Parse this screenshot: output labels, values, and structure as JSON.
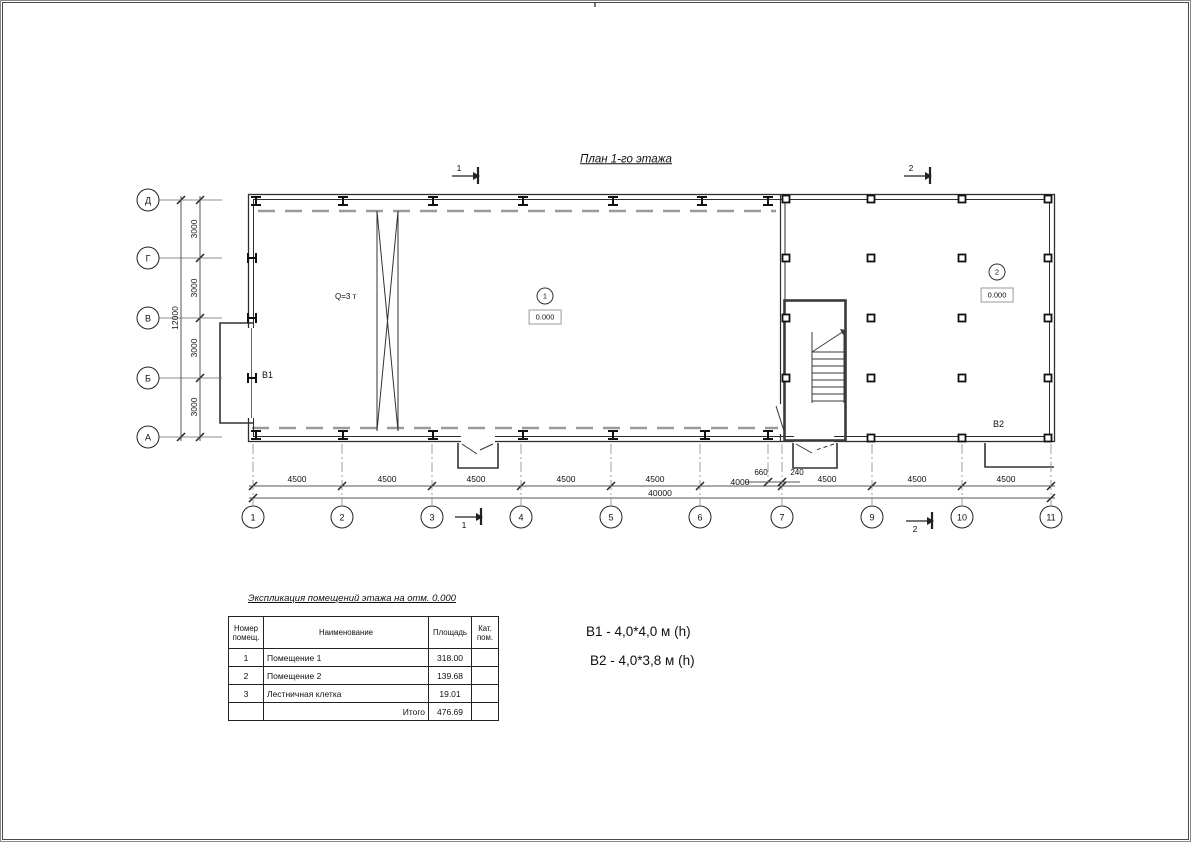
{
  "title": "План 1-го этажа",
  "plan": {
    "crane_label": "Q=3 т",
    "room_markers": {
      "r1": "1",
      "r2": "2"
    },
    "elevations": {
      "e1": "0.000",
      "e2": "0.000"
    },
    "b1": "В1",
    "b2": "В2"
  },
  "grid": {
    "row_labels": [
      "Д",
      "Г",
      "В",
      "Б",
      "А"
    ],
    "col_labels": [
      "1",
      "2",
      "3",
      "4",
      "5",
      "6",
      "7",
      "9",
      "10",
      "11"
    ]
  },
  "dims": {
    "left_segments": [
      "3000",
      "3000",
      "3000",
      "3000"
    ],
    "left_total": "12000",
    "bottom_segments": [
      "4500",
      "4500",
      "4500",
      "4500",
      "4500",
      "4000",
      "4500",
      "4500",
      "4500"
    ],
    "bottom_small": [
      "660",
      "240"
    ],
    "bottom_total": "40000"
  },
  "sections": {
    "top_1": "1",
    "top_2": "2",
    "bottom_1": "1",
    "bottom_2": "2"
  },
  "legend": {
    "line1": "В1  -  4,0*4,0 м (h)",
    "line2": "В2 - 4,0*3,8 м (h)"
  },
  "table": {
    "title": "Экспликация помещений этажа на отм. 0.000",
    "headers": [
      "Номер помещ.",
      "Наименование",
      "Площадь",
      "Кат. пом."
    ],
    "rows": [
      {
        "num": "1",
        "name": "Помещение 1",
        "area": "318.00",
        "cat": ""
      },
      {
        "num": "2",
        "name": "Помещение 2",
        "area": "139.68",
        "cat": ""
      },
      {
        "num": "3",
        "name": "Лестничная клетка",
        "area": "19.01",
        "cat": ""
      }
    ],
    "total_label": "Итого",
    "total_value": "476.69"
  }
}
